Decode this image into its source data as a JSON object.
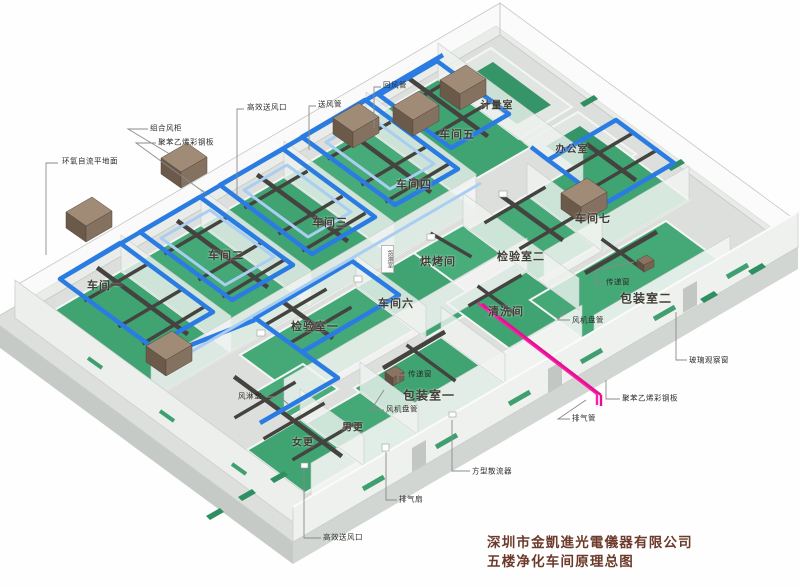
{
  "title": {
    "company": "深圳市金凱進光電儀器有限公司",
    "drawing": "五楼净化车间原理总图"
  },
  "rooms": [
    {
      "name": "车间一"
    },
    {
      "name": "车间二"
    },
    {
      "name": "车间三"
    },
    {
      "name": "车间四"
    },
    {
      "name": "车间五"
    },
    {
      "name": "车间六"
    },
    {
      "name": "车间七"
    },
    {
      "name": "计量室"
    },
    {
      "name": "办公室"
    },
    {
      "name": "检验室一"
    },
    {
      "name": "检验室二"
    },
    {
      "name": "烘烤间"
    },
    {
      "name": "清洗间"
    },
    {
      "name": "货淋室"
    },
    {
      "name": "包装室一"
    },
    {
      "name": "包装室二"
    },
    {
      "name": "男更"
    },
    {
      "name": "女更"
    }
  ],
  "callouts": [
    {
      "text": "环氧自流平地面"
    },
    {
      "text": "组合风柜"
    },
    {
      "text": "聚苯乙烯彩钢板"
    },
    {
      "text": "高效送风口"
    },
    {
      "text": "送风管"
    },
    {
      "text": "回风管"
    },
    {
      "text": "传递窗"
    },
    {
      "text": "风机盘管"
    },
    {
      "text": "玻璃观察窗"
    },
    {
      "text": "聚苯乙烯彩钢板"
    },
    {
      "text": "排气管"
    },
    {
      "text": "风淋室"
    },
    {
      "text": "传递窗"
    },
    {
      "text": "风机盘管"
    },
    {
      "text": "方型散流器"
    },
    {
      "text": "排气扇"
    },
    {
      "text": "高效送风口"
    }
  ],
  "palette": {
    "floor_green": "#3fa372",
    "floor_green_light": "#5cbd8c",
    "duct_blue": "#2b7ce2",
    "duct_light_blue": "#a9cef1",
    "duct_dark_gray": "#45433f",
    "ahu_brown_top": "#a08b76",
    "ahu_brown_front": "#6b594a",
    "exhaust_pipe_magenta": "#ff1ca8",
    "slab_gray": "#dcdfdc",
    "wall_white": "#eff1ef",
    "title_color": "#6b3a2a"
  }
}
